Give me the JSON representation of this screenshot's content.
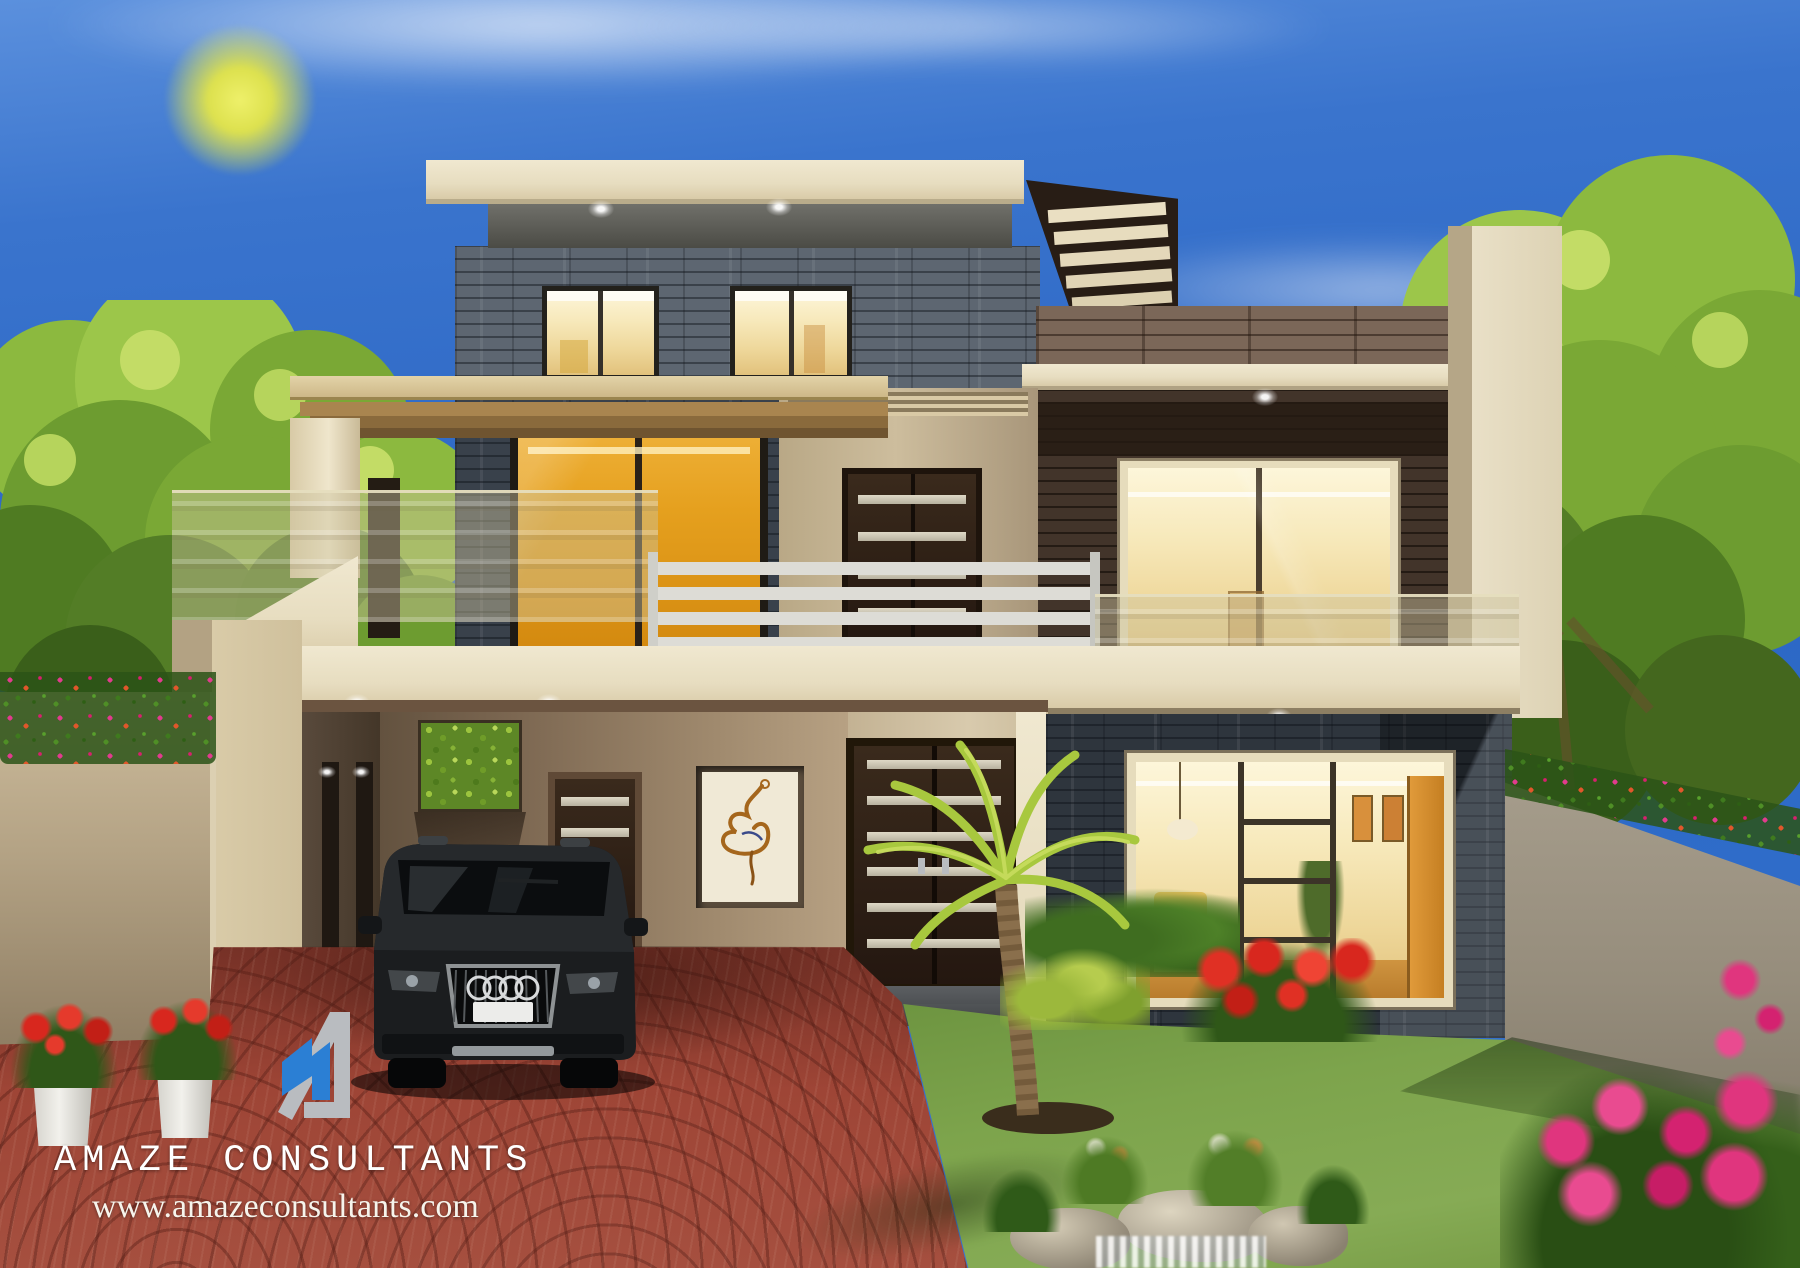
{
  "branding": {
    "company": "AMAZE CONSULTANTS",
    "website": "www.amazeconsultants.com",
    "logo_icon": "abstract-house-monogram",
    "logo_blue": "#2b7fd4",
    "logo_gray": "#b9bcc0",
    "text_color": "#ffffff"
  },
  "scene": {
    "type": "3d-architectural-render",
    "subject": "modern double-storey house front elevation with lawn, driveway and parked SUV",
    "sky": {
      "top": "#5b90dd",
      "main": "#2b66c4",
      "sun": "#dde14e",
      "clouds": "#ffffff"
    },
    "house": {
      "facade_cream": "#e9dfc4",
      "stone_gray": "#5d6671",
      "slate_dark": "#2e353d",
      "wood_parapet": "#7b6758",
      "wood_cladding_dark": "#42342a",
      "balcony_railing_white": "#dddcd6",
      "glass_balustrade_tint": "rgba(205,195,158,0.45)",
      "lit_window_warm": "#f7e9bb",
      "accent_door_amber": "#e5a01e",
      "entry_door_brown": "#2e2118",
      "calligraphy_art": "arabic-calligraphy-panel"
    },
    "landscape": {
      "lawn_green": "#7da44c",
      "driveway_brick": "#9e4536",
      "tree_green": "#7fae3c",
      "boundary_wall": "#a39a8a",
      "wall_flowers_pink": "#e23b8e",
      "potted_flowers_red": "#d8271e",
      "rock_feature": "#cfc6b0",
      "palm_tree": "yellow-green-fan-palm"
    },
    "vehicle": {
      "type": "black luxury SUV",
      "color": "#17191b",
      "badge": "four-rings-grille-badge",
      "license_plate_text": ""
    }
  }
}
